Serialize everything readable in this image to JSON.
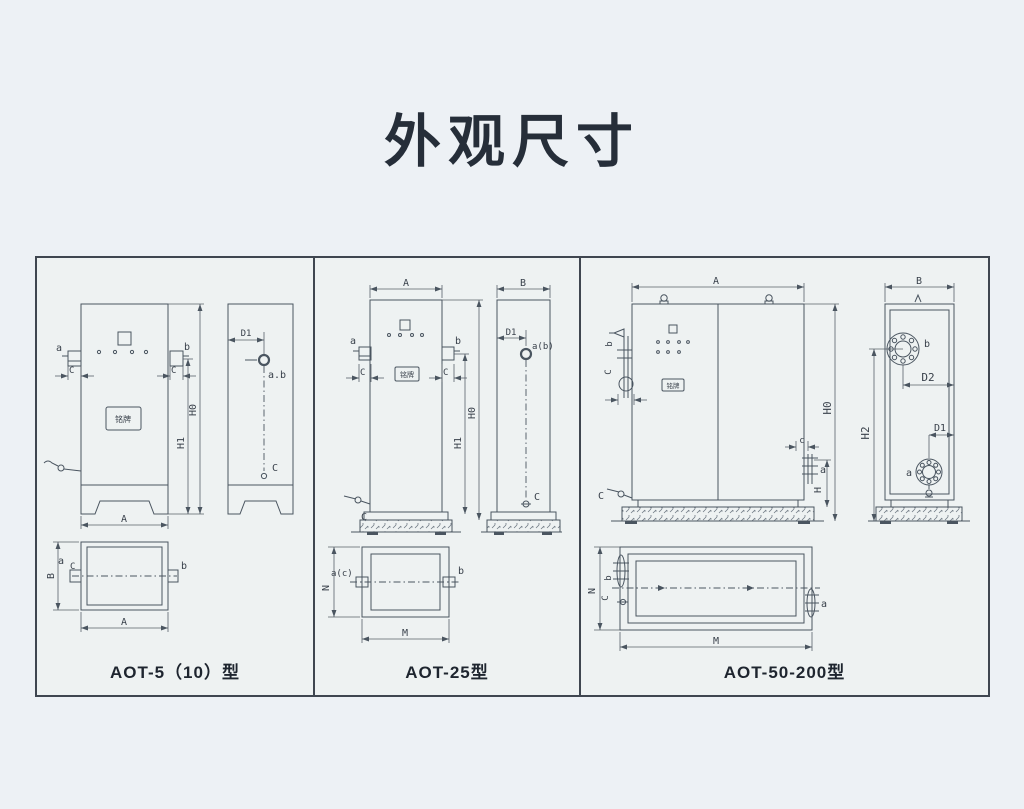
{
  "page": {
    "title": "外观尺寸"
  },
  "colors": {
    "background": "#edf1f5",
    "board_background": "#eef2f2",
    "line": "#4a5560",
    "border": "#3f4650",
    "title_text": "#262e39",
    "caption_text": "#1e252f",
    "label_text": "#39414b"
  },
  "panels": [
    {
      "caption": "AOT-5（10）型",
      "nameplate": "铭牌",
      "front": {
        "a": "a",
        "b": "b",
        "c_left": "C",
        "c_right": "C",
        "h1": "H1",
        "h0": "H0",
        "width": "A"
      },
      "side": {
        "d1": "D1",
        "ab": "a.b",
        "c": "C"
      },
      "top": {
        "height": "B",
        "a": "a",
        "c": "C",
        "b": "b",
        "width": "A"
      }
    },
    {
      "caption": "AOT-25型",
      "nameplate": "铭牌",
      "front": {
        "width": "A",
        "a": "a",
        "b": "b",
        "c_left": "C",
        "c_right": "C",
        "h1": "H1",
        "h0": "H0",
        "c_valve": "C"
      },
      "side": {
        "width": "B",
        "d1": "D1",
        "ab": "a(b)",
        "c": "C"
      },
      "top": {
        "height": "N",
        "ac": "a(c)",
        "b": "b",
        "width": "M"
      }
    },
    {
      "caption": "AOT-50-200型",
      "nameplate": "铭牌",
      "front": {
        "width": "A",
        "b": "b",
        "c_left": "C",
        "c_small": "c",
        "a": "a",
        "h": "H",
        "h0": "H0",
        "c_valve": "C"
      },
      "side": {
        "width": "B",
        "b": "b",
        "d2": "D2",
        "h2": "H2",
        "d1": "D1",
        "a": "a"
      },
      "top": {
        "height": "N",
        "b": "b",
        "c": "C",
        "a": "a",
        "width": "M"
      }
    }
  ]
}
